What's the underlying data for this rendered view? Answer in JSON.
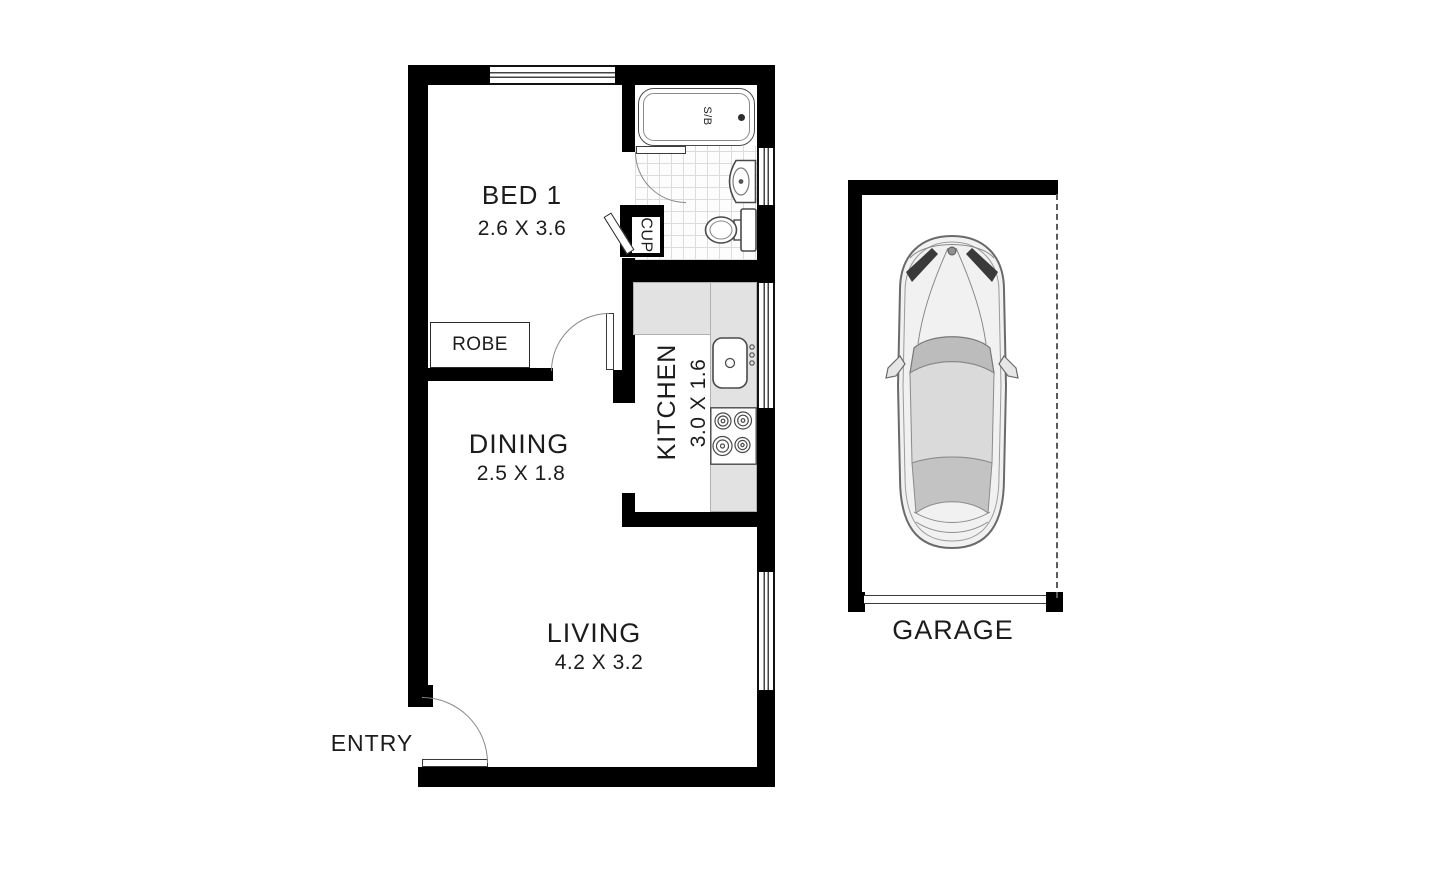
{
  "diagram_title": "Apartment floor plan with garage",
  "rooms": {
    "bed1": {
      "label": "BED 1",
      "dims": "2.6 X 3.6"
    },
    "dining": {
      "label": "DINING",
      "dims": "2.5 X 1.8"
    },
    "kitchen": {
      "label": "KITCHEN",
      "dims": "3.0 X 1.6"
    },
    "living": {
      "label": "LIVING",
      "dims": "4.2 X 3.2"
    },
    "garage": {
      "label": "GARAGE"
    }
  },
  "features": {
    "entry": "ENTRY",
    "robe": "ROBE",
    "cupboard": "CUP",
    "bath_shower": "S/B"
  },
  "colors": {
    "wall": "#000000",
    "counter": "#e2e2e2",
    "tile_line": "#dcdcdc",
    "door_arc": "#8a8a8a",
    "fixture_outline": "#4a4a4a",
    "car_body": "#f1f1f1",
    "car_glass": "#bcbcbc",
    "car_roof": "#dadada"
  }
}
